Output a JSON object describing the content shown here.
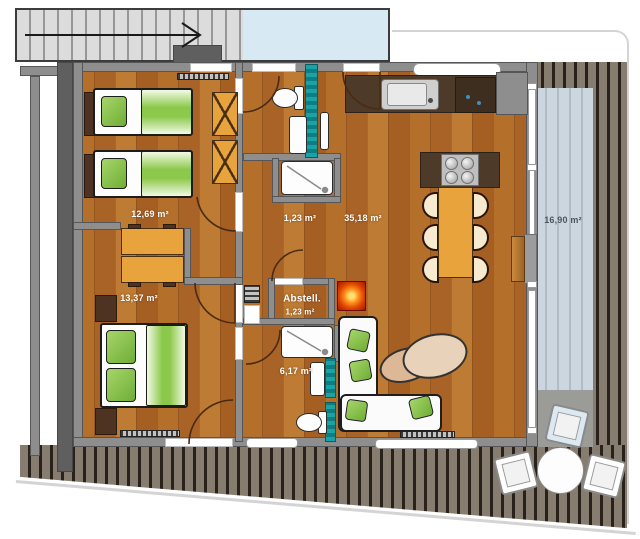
{
  "plan_title": "apartment-floor-plan",
  "rooms": {
    "bedroom_top": {
      "area": "12,69 m²"
    },
    "bedroom_bottom": {
      "area": "13,37 m²"
    },
    "bathroom_top": {
      "area": "1,23 m²"
    },
    "living_kitchen": {
      "area": "35,18 m²"
    },
    "storage": {
      "name": "Abstell.",
      "area": "1,23 m²"
    },
    "bathroom_bottom": {
      "area": "6,17 m²"
    },
    "balcony": {
      "area": "16,90 m²"
    }
  },
  "colors": {
    "wood_floor": "#b4702b",
    "wall_gray": "#8e8e8e",
    "deck_plank": "#867c70",
    "deck_gap": "#29221b",
    "balcony_blue": "#cbd6de",
    "stair_landing_blue": "#d7e9f3",
    "tile_teal": "#14999c",
    "textile_green": "#8cc84b",
    "furniture_orange": "#e8a33d",
    "kitchen_counter": "#4e3a29",
    "fireplace_glow": "#e04a00"
  },
  "icons": {
    "stair_direction_arrow": "→"
  }
}
